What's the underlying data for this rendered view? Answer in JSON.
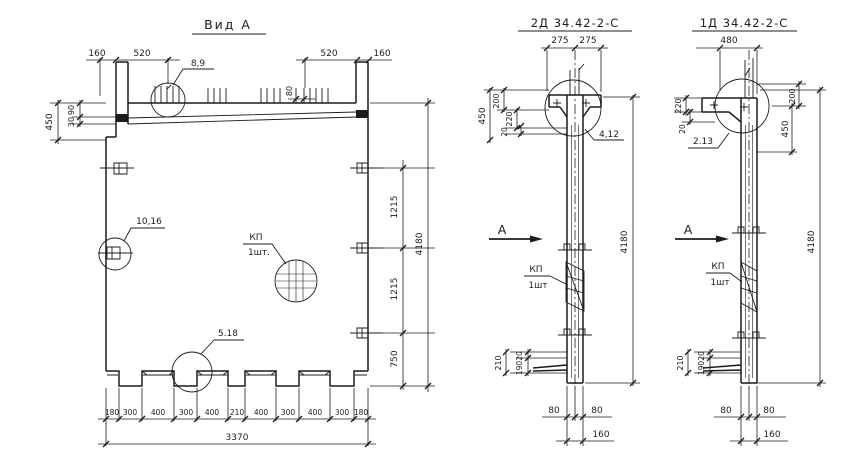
{
  "drawing": {
    "background": "#ffffff",
    "ink": "#1c1c1c",
    "view_a": {
      "title": "Вид А",
      "details": {
        "top": "8,9",
        "left": "10,16",
        "bottom": "5.18"
      },
      "mesh": {
        "name": "КП",
        "qty": "1шт."
      },
      "dims": {
        "top": [
          "160",
          "520",
          "520",
          "160"
        ],
        "bar_spacing": "80",
        "left": [
          "450",
          "90",
          "30"
        ],
        "right": [
          "1215",
          "1215",
          "750"
        ],
        "height": "4180",
        "bottom_segments": [
          "180",
          "300",
          "400",
          "300",
          "400",
          "210",
          "400",
          "300",
          "400",
          "300",
          "180"
        ],
        "bottom_total": "3370"
      }
    },
    "view_2d": {
      "title": "2Д 34.42-2-С",
      "section_mark": "А",
      "detail": "4,12",
      "mesh": {
        "name": "КП",
        "qty": "1шт"
      },
      "dims": {
        "top": [
          "275",
          "275"
        ],
        "left_total": "450",
        "left": [
          "200",
          "220",
          "20"
        ],
        "height": "4180",
        "foot": [
          "210",
          "20",
          "190"
        ],
        "bottom": [
          "80",
          "80",
          "160"
        ]
      }
    },
    "view_1d": {
      "title": "1Д 34.42-2-С",
      "section_mark": "А",
      "detail": "2.13",
      "mesh": {
        "name": "КП",
        "qty": "1шт"
      },
      "dims": {
        "top": "480",
        "left": [
          "220",
          "20"
        ],
        "right": [
          "200",
          "450"
        ],
        "height": "4180",
        "foot": [
          "210",
          "20",
          "190"
        ],
        "bottom": [
          "80",
          "80",
          "160"
        ]
      }
    }
  }
}
